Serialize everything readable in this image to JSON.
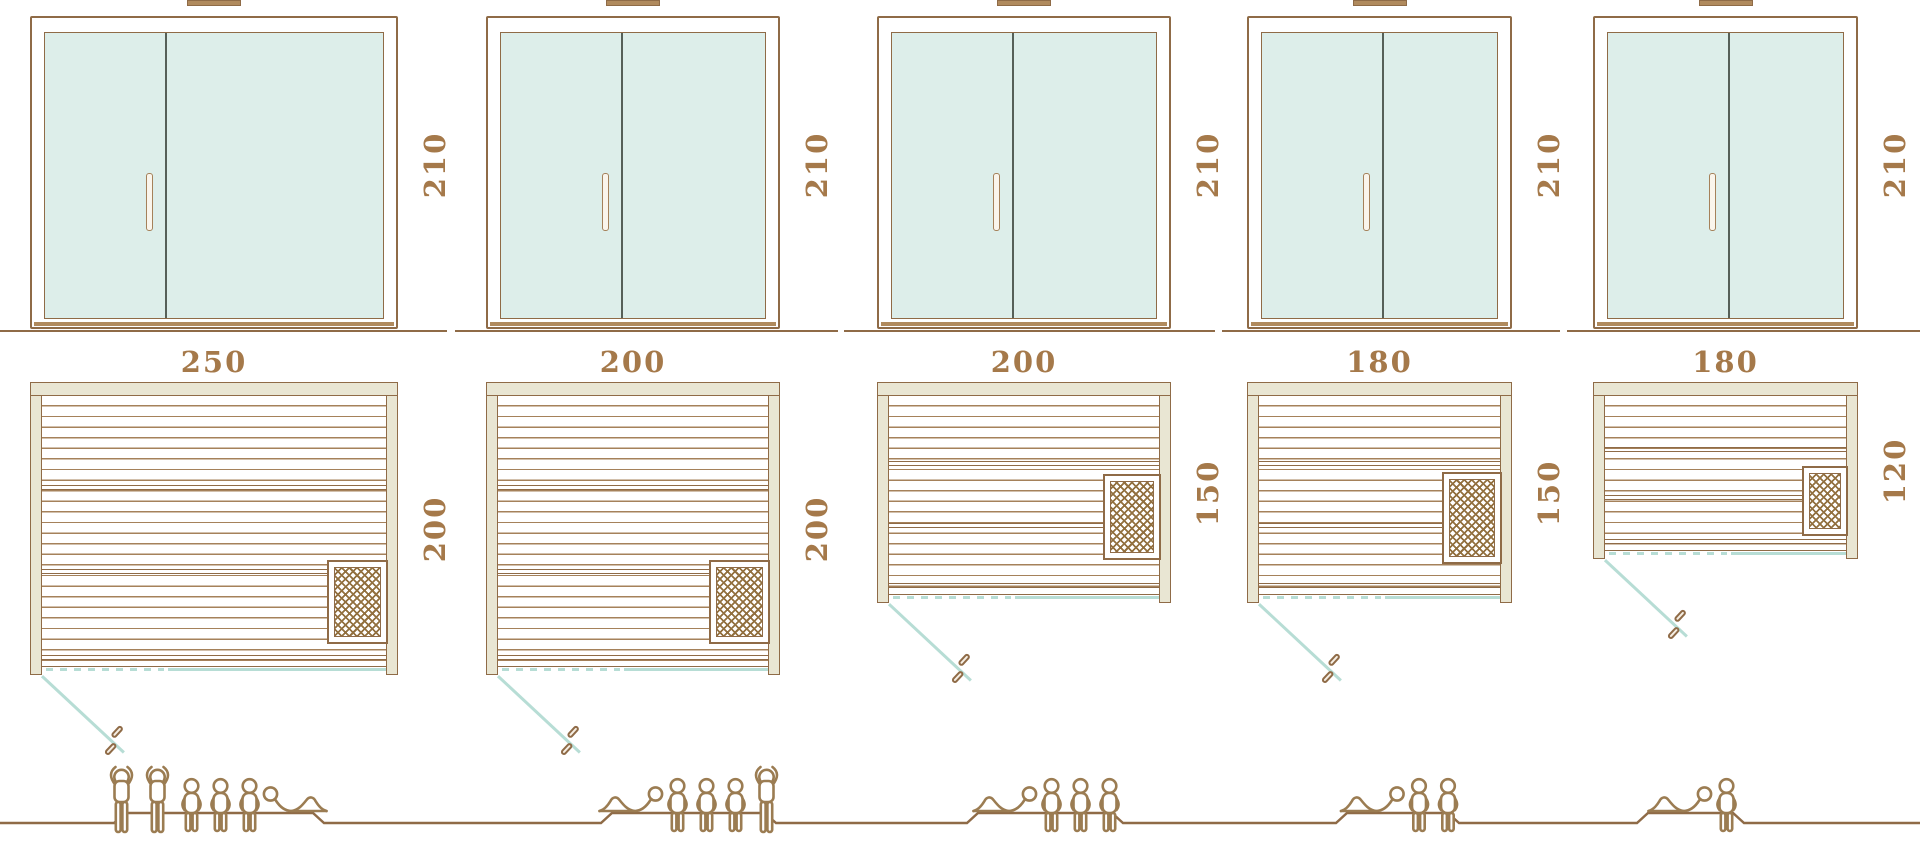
{
  "colors": {
    "line_brown": "#8f6b47",
    "label_brown": "#a5794a",
    "wall_beige": "#e9e6d3",
    "glass_mint": "#ddeeea",
    "teal_line": "#b7ddd5",
    "people_brown": "#9b7c52"
  },
  "saunas": [
    {
      "width": "250",
      "depth": "200",
      "door_height": "210",
      "capacity": 6,
      "people": [
        "standing",
        "standing",
        "seated",
        "seated",
        "seated",
        "lying-head-left"
      ]
    },
    {
      "width": "200",
      "depth": "200",
      "door_height": "210",
      "capacity": 5,
      "people": [
        "lying-head-right",
        "seated",
        "seated",
        "seated",
        "standing"
      ]
    },
    {
      "width": "200",
      "depth": "150",
      "door_height": "210",
      "capacity": 4,
      "people": [
        "lying-head-right",
        "seated",
        "seated",
        "seated"
      ]
    },
    {
      "width": "180",
      "depth": "150",
      "door_height": "210",
      "capacity": 3,
      "people": [
        "lying-head-right",
        "seated",
        "seated"
      ]
    },
    {
      "width": "180",
      "depth": "120",
      "door_height": "210",
      "capacity": 2,
      "people": [
        "lying-head-right",
        "seated"
      ]
    }
  ]
}
